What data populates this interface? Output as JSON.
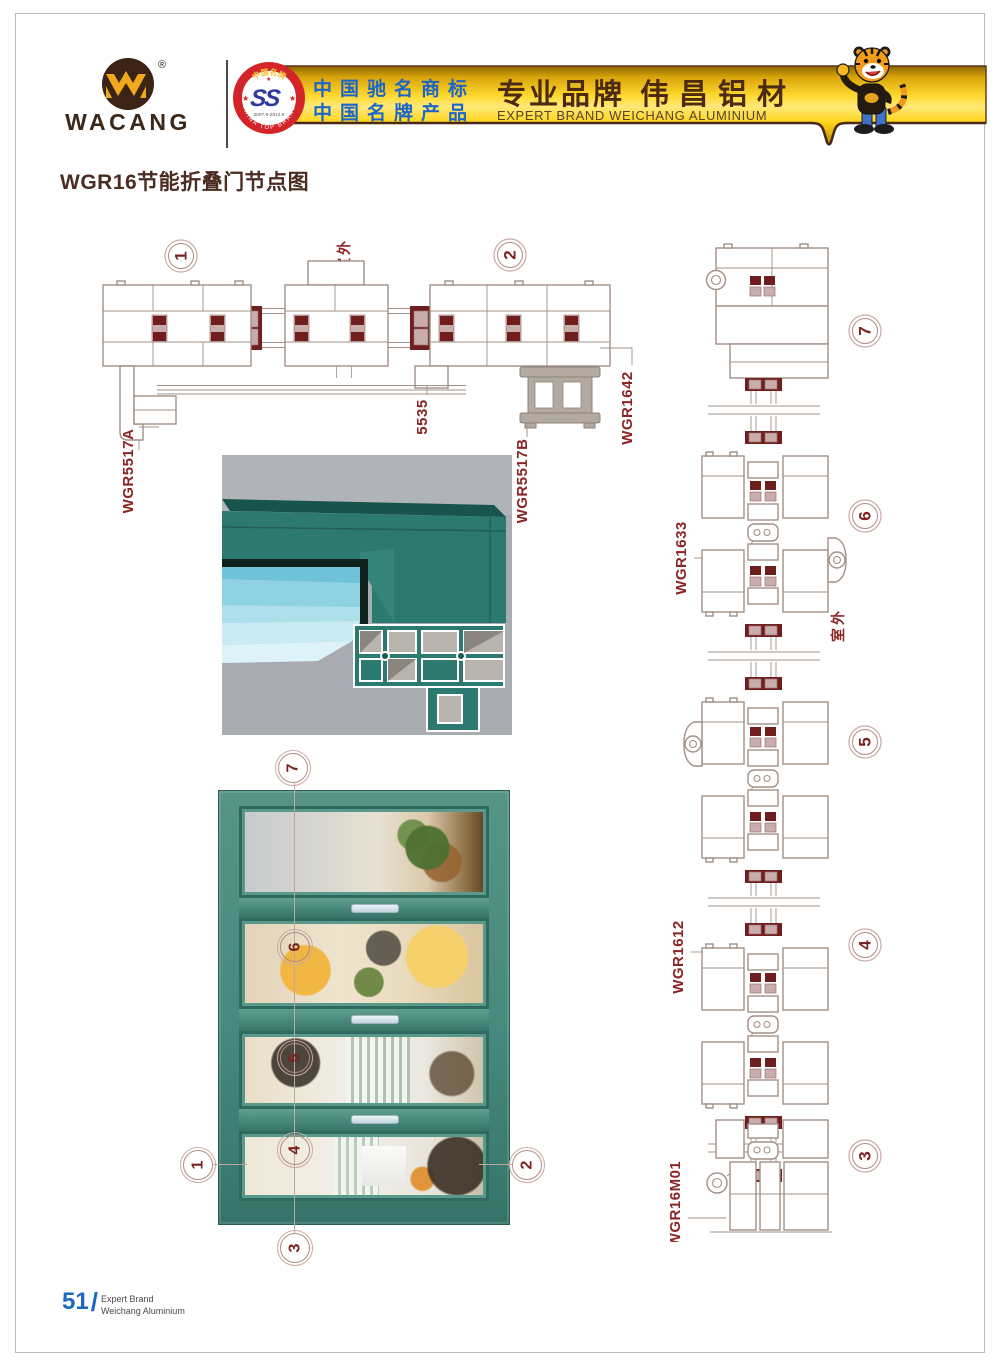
{
  "header": {
    "brand": "WACANG",
    "registered": "®",
    "badge": {
      "top": "中国名牌",
      "bottom": "CHINA TOP BRAND",
      "emblem": "SS",
      "years": "2007.9-2012.9"
    },
    "banner": {
      "trademark_line1": "中国驰名商标",
      "trademark_line2": "中国名牌产品",
      "slogan_cn": "专业品牌",
      "brand_cn": "伟昌铝材",
      "slogan_en": "EXPERT BRAND WEICHANG ALUMINIUM"
    }
  },
  "title": "WGR16节能折叠门节点图",
  "top_drawing": {
    "callout_1": "1",
    "callout_2": "2",
    "outdoor": "室外",
    "labels": {
      "a": "WGR5517A",
      "b": "5535",
      "c": "WGR5517B",
      "d": "WGR1642"
    }
  },
  "right_drawing": {
    "callout_7": "7",
    "callout_6": "6",
    "callout_5": "5",
    "callout_4": "4",
    "callout_3": "3",
    "outdoor": "室外",
    "labels": {
      "a": "WGR1633",
      "b": "WGR1612",
      "c": "WGR16M01"
    }
  },
  "photo": {
    "callout_7": "7",
    "callout_6": "6",
    "callout_5": "5",
    "callout_4": "4",
    "callout_1": "1",
    "callout_2": "2",
    "callout_3": "3"
  },
  "footer": {
    "page": "51",
    "sep": "/",
    "line1": "Expert Brand",
    "line2": "Weichang Aluminium"
  },
  "colors": {
    "label_red": "#8b2424",
    "digit_maroon": "#7d2020",
    "gasket_maroon": "#6f1d1d",
    "line_gray": "#a29086",
    "banner_gold": "#ffd92e",
    "banner_text_blue": "#1b66c8",
    "banner_text_brown": "#4b2a10",
    "badge_red": "#d3242a",
    "render_teal": "#2c7a6f",
    "door_green": "#47897e",
    "footer_blue": "#1a6ac1"
  }
}
